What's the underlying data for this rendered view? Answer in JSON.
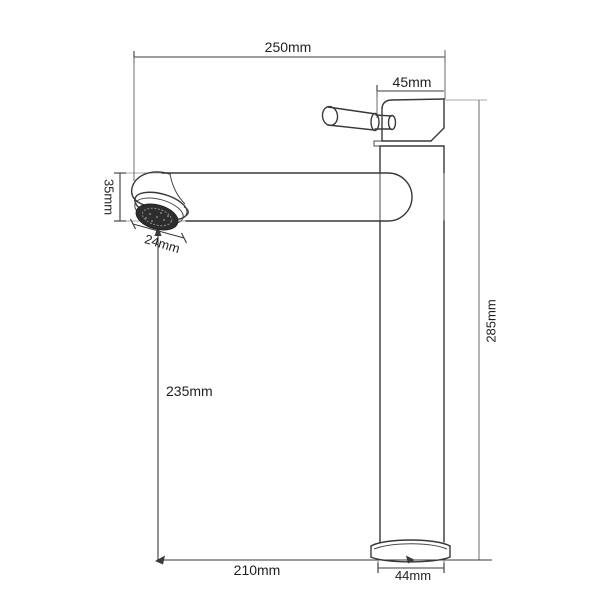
{
  "page": {
    "background": "#ffffff"
  },
  "drawing": {
    "type": "technical-dimension-diagram",
    "subject": "tall single-lever basin mixer faucet, side elevation line drawing",
    "colors": {
      "outline": "#383838",
      "dimension_line": "#3a3a3a",
      "extension_line": "#aaaaaa",
      "text": "#1f1f1f",
      "aerator_fill": "#2e2e2e",
      "background": "#ffffff"
    },
    "dimensions": [
      {
        "id": "spout-reach-top",
        "label": "250mm",
        "orientation": "horizontal"
      },
      {
        "id": "handle-body-width",
        "label": "45mm",
        "orientation": "horizontal"
      },
      {
        "id": "spout-end-height",
        "label": "35mm",
        "orientation": "vertical-rotated-cw"
      },
      {
        "id": "aerator-diameter",
        "label": "24mm",
        "orientation": "diagonal"
      },
      {
        "id": "outlet-to-base",
        "label": "235mm",
        "orientation": "vertical"
      },
      {
        "id": "total-height",
        "label": "285mm",
        "orientation": "vertical-rotated-ccw"
      },
      {
        "id": "outlet-to-axis",
        "label": "210mm",
        "orientation": "horizontal"
      },
      {
        "id": "base-diameter",
        "label": "44mm",
        "orientation": "horizontal"
      }
    ]
  }
}
